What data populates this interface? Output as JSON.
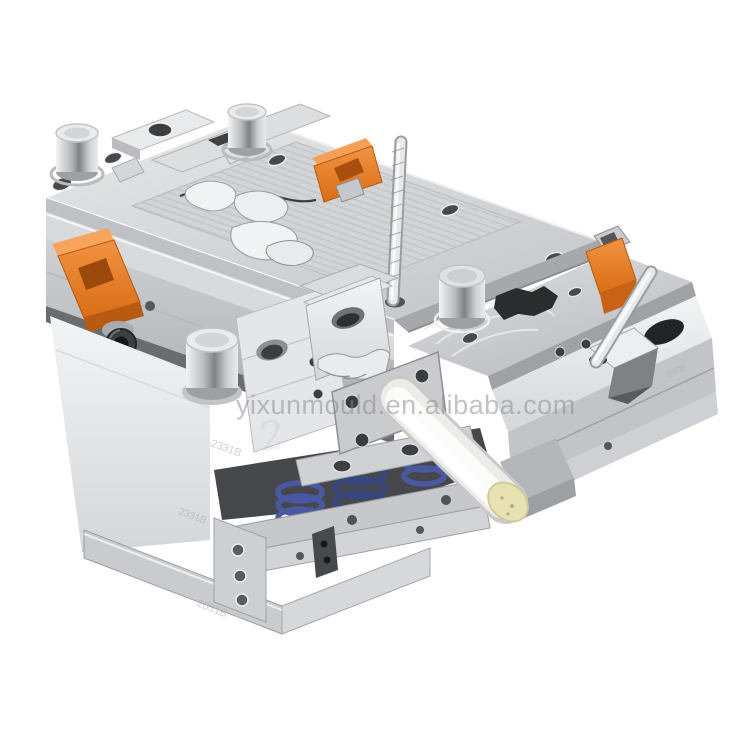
{
  "photo": {
    "subject": "Plastic injection mould tooling (two-plate mold base), isometric studio product photo",
    "background": "#ffffff"
  },
  "watermark": {
    "text": "yixunmould.en.alibaba.com",
    "color_hex": "#85878a"
  },
  "engravings": {
    "plate_marks": [
      "2331B",
      "2331B",
      "2031B",
      "030B"
    ],
    "ghost_mark": "2"
  },
  "colors": {
    "steel_light": "#e9ebed",
    "steel_mid": "#c7c9cc",
    "steel_dark": "#9b9da0",
    "gap_shadow": "#45474a",
    "clamp_orange": "#e87a28",
    "clamp_orange_dark": "#c05c12",
    "spring_blue": "#4a58a2",
    "roller_white": "#f7f7f5",
    "roller_cap_cream": "#e8e1b2",
    "chrome": "#d8dadc"
  }
}
